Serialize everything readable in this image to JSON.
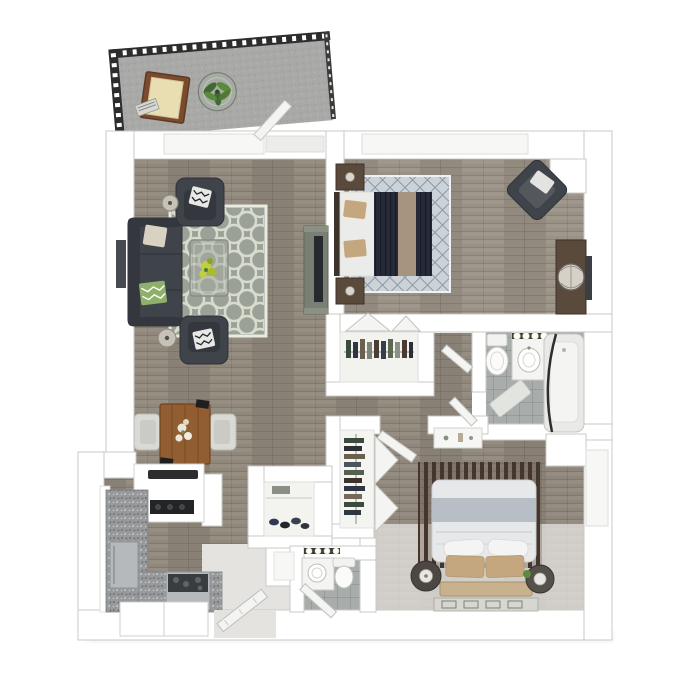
{
  "scene": {
    "type": "3d-floor-plan-top-view",
    "description": "One-bedroom-plus-den style apartment 3D floor plan render, no text labels",
    "rooms": [
      {
        "name": "balcony",
        "items": [
          "striped-railing",
          "wood-lounge-chair",
          "round-plant-table",
          "open-glass-door"
        ]
      },
      {
        "name": "living-room",
        "items": [
          "charcoal-sofa",
          "armchair-top",
          "armchair-bottom",
          "quatrefoil-rug",
          "glass-coffee-table",
          "floor-lamp",
          "floor-lamp",
          "media-console-with-tv",
          "wall-art"
        ]
      },
      {
        "name": "dining-area",
        "items": [
          "wood-dining-table",
          "side-chair",
          "side-chair",
          "flower-centerpiece"
        ]
      },
      {
        "name": "kitchen",
        "items": [
          "peninsula-counter-sink",
          "black-cooktop",
          "refrigerator",
          "range-oven",
          "granite-l-counter",
          "base-cabinets"
        ]
      },
      {
        "name": "bedroom-one",
        "items": [
          "bed-navy-duvet",
          "nightstand",
          "nightstand",
          "diamond-lattice-rug",
          "corner-armchair",
          "media-dresser",
          "reach-in-closet-bifold-doors"
        ]
      },
      {
        "name": "bathroom-one",
        "items": [
          "toilet",
          "vanity-sink-with-bulbs",
          "bathtub-curved-rod",
          "bath-mat",
          "door"
        ]
      },
      {
        "name": "hallway",
        "items": [
          "door-leaf",
          "door-leaf"
        ]
      },
      {
        "name": "master-bedroom",
        "items": [
          "bed-white-duvet",
          "slat-accent-panel",
          "round-nightstand-lamp",
          "round-nightstand-lamp",
          "runner-rug",
          "wall-shelf",
          "bifold-closet",
          "window"
        ]
      },
      {
        "name": "bathroom-two",
        "items": [
          "toilet",
          "vanity-sink-with-bulbs",
          "door"
        ]
      },
      {
        "name": "entry",
        "items": [
          "open-front-door",
          "shoe-closet",
          "storage-niche"
        ]
      }
    ]
  },
  "colors": {
    "bg": "#ffffff",
    "wall": "#ffffff",
    "wallStroke": "#c9c9c6",
    "woodLiving": "#8d8478",
    "woodBed1": "#968d82",
    "woodMaster": "#8b8277",
    "floorLight": "#e4e3df",
    "tile": "#a6aba9",
    "balcFloor": "#a9a9a7",
    "rail": "#2d2d2d",
    "charcoal": "#3f434a",
    "charcoalDark": "#34383e",
    "navy": "#262b3a",
    "tan": "#c4a77e",
    "runnerTan": "#a6947e",
    "sheetWhite": "#ebebe9",
    "rugGray": "#9ba196",
    "rugPattern": "#d8dccf",
    "rugBlue": "#ccd3d8",
    "rugBlueLine": "#8d99a5",
    "wdDark": "#5a4a3c",
    "wdDarker": "#3e332b",
    "slat": "#44362c",
    "granite": "#97999b",
    "stainless": "#b5b9bc",
    "glass": "#a6aca3",
    "plantGreen": "#5c8a3d",
    "greenDark": "#3f6b31",
    "cream": "#e8deb2",
    "chairWood": "#7c4b2e",
    "diningWood": "#935d32",
    "doorWhite": "#f4f4f2",
    "fixWhite": "#f7f7f5",
    "bulbStrip": "#3c3c3e",
    "pillowGreen": "#8fb06a",
    "flowerYellow": "#bfcf3e",
    "tvDark": "#26292e",
    "consoleGreen": "#7a7f73",
    "duvetWhite": "#e7e8ea",
    "duvetBand": "#b7bec6",
    "headboardTan": "#c8b18d"
  }
}
